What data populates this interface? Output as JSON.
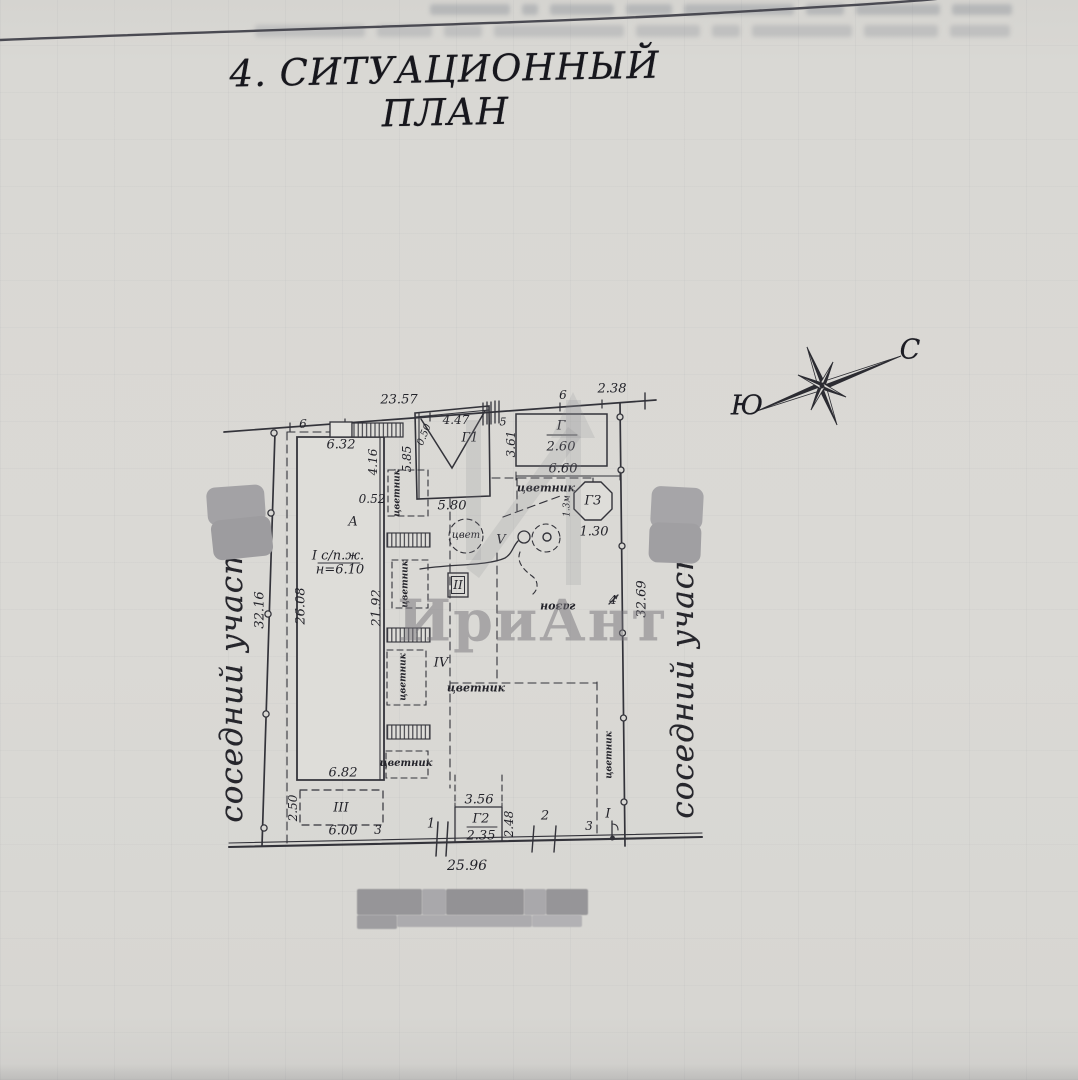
{
  "page": {
    "title": "4. СИТУАЦИОННЫЙ ПЛАН"
  },
  "compass": {
    "north_label": "С",
    "south_label": "Ю"
  },
  "site": {
    "neighbor_left": "соседний участок",
    "neighbor_right": "соседний участок",
    "watermark": "ИриАнт"
  },
  "colors": {
    "paper": "#d9d8d4",
    "ink": "#2b2b31",
    "watermark": "#8a8890"
  },
  "plan": {
    "labels": [
      {
        "n": "dim-23-57",
        "t": "23.57",
        "x": 399,
        "y": 400,
        "s": 13
      },
      {
        "n": "dim-6-a",
        "t": "6",
        "x": 303,
        "y": 424,
        "s": 12
      },
      {
        "n": "dim-6-32",
        "t": "6.32",
        "x": 341,
        "y": 445,
        "s": 13
      },
      {
        "n": "dim-4-16",
        "t": "4.16",
        "x": 373,
        "y": 462,
        "r": -90,
        "s": 12
      },
      {
        "n": "dim-5-85",
        "t": "5.85",
        "x": 407,
        "y": 459,
        "r": -90,
        "s": 12
      },
      {
        "n": "dim-0-50",
        "t": "0.50",
        "x": 425,
        "y": 435,
        "r": -68,
        "s": 10
      },
      {
        "n": "dim-4-47",
        "t": "4.47",
        "x": 456,
        "y": 420,
        "s": 12
      },
      {
        "n": "label-g1",
        "t": "Г1",
        "x": 470,
        "y": 438,
        "s": 13
      },
      {
        "n": "dim-5-b",
        "t": "5",
        "x": 503,
        "y": 422,
        "s": 11
      },
      {
        "n": "dim-3-61",
        "t": "3.61",
        "x": 511,
        "y": 444,
        "r": -90,
        "s": 12
      },
      {
        "n": "dim-6-b",
        "t": "6",
        "x": 563,
        "y": 395,
        "s": 12
      },
      {
        "n": "dim-2-38",
        "t": "2.38",
        "x": 612,
        "y": 389,
        "s": 13
      },
      {
        "n": "label-g",
        "t": "Г",
        "x": 561,
        "y": 426,
        "s": 13
      },
      {
        "n": "dim-2-60",
        "t": "2.60",
        "x": 561,
        "y": 447,
        "s": 13
      },
      {
        "n": "dim-6-60",
        "t": "6.60",
        "x": 563,
        "y": 469,
        "s": 13
      },
      {
        "n": "label-cvetnik-top",
        "t": "цветник",
        "x": 546,
        "y": 488,
        "s": 11,
        "b": 1
      },
      {
        "n": "label-g3",
        "t": "Г3",
        "x": 593,
        "y": 501,
        "s": 13
      },
      {
        "n": "dim-1-30",
        "t": "1.30",
        "x": 594,
        "y": 532,
        "s": 13
      },
      {
        "n": "dim-1-3m",
        "t": "1.3м",
        "x": 568,
        "y": 506,
        "r": -90,
        "s": 9
      },
      {
        "n": "label-cvet",
        "t": "цвет",
        "x": 466,
        "y": 536,
        "s": 10
      },
      {
        "n": "label-v",
        "t": "V",
        "x": 501,
        "y": 540,
        "s": 13
      },
      {
        "n": "dim-5-80",
        "t": "5.80",
        "x": 452,
        "y": 506,
        "s": 13
      },
      {
        "n": "dim-0-52",
        "t": "0.52",
        "x": 372,
        "y": 499,
        "s": 12
      },
      {
        "n": "label-a",
        "t": "А",
        "x": 353,
        "y": 522,
        "s": 13
      },
      {
        "n": "label-i-spzh",
        "t": "I с/п.ж.",
        "x": 338,
        "y": 556,
        "s": 13
      },
      {
        "n": "dim-n-6-10",
        "t": "н=6.10",
        "x": 340,
        "y": 570,
        "s": 13
      },
      {
        "n": "dim-26-08",
        "t": "26.08",
        "x": 301,
        "y": 606,
        "r": -90,
        "s": 13
      },
      {
        "n": "dim-32-16",
        "t": "32.16",
        "x": 260,
        "y": 610,
        "r": -90,
        "s": 13
      },
      {
        "n": "dim-21-92",
        "t": "21.92",
        "x": 377,
        "y": 608,
        "r": -90,
        "s": 13
      },
      {
        "n": "cvetnik-v0",
        "t": "цветник",
        "x": 398,
        "y": 493,
        "r": -90,
        "s": 9,
        "b": 1
      },
      {
        "n": "cvetnik-v1",
        "t": "цветник",
        "x": 406,
        "y": 584,
        "r": -90,
        "s": 9,
        "b": 1
      },
      {
        "n": "cvetnik-v2",
        "t": "цветник",
        "x": 404,
        "y": 677,
        "r": -90,
        "s": 9,
        "b": 1
      },
      {
        "n": "label-ii",
        "t": "II",
        "x": 458,
        "y": 585,
        "s": 12
      },
      {
        "n": "label-iv",
        "t": "IV",
        "x": 441,
        "y": 663,
        "s": 13
      },
      {
        "n": "label-cvetnik-mid",
        "t": "цветник",
        "x": 476,
        "y": 688,
        "s": 11,
        "b": 1
      },
      {
        "n": "label-gazon",
        "t": "газон",
        "x": 558,
        "y": 607,
        "r": 180,
        "s": 11,
        "b": 1
      },
      {
        "n": "dim-4",
        "t": "4",
        "x": 613,
        "y": 600,
        "s": 12
      },
      {
        "n": "dim-32-69",
        "t": "32.69",
        "x": 642,
        "y": 599,
        "r": -90,
        "s": 13
      },
      {
        "n": "cvetnik-h3",
        "t": "цветник",
        "x": 406,
        "y": 764,
        "s": 10,
        "b": 1
      },
      {
        "n": "cvetnik-v3",
        "t": "цветник",
        "x": 610,
        "y": 755,
        "r": -90,
        "s": 9,
        "b": 1
      },
      {
        "n": "dim-6-82",
        "t": "6.82",
        "x": 343,
        "y": 773,
        "s": 13
      },
      {
        "n": "dim-2-50",
        "t": "2.50",
        "x": 293,
        "y": 808,
        "r": -90,
        "s": 12
      },
      {
        "n": "label-iii",
        "t": "III",
        "x": 341,
        "y": 808,
        "s": 13
      },
      {
        "n": "dim-6-00",
        "t": "6.00",
        "x": 343,
        "y": 831,
        "s": 13
      },
      {
        "n": "dim-3-a",
        "t": "3",
        "x": 378,
        "y": 830,
        "s": 12
      },
      {
        "n": "gate-1",
        "t": "1",
        "x": 431,
        "y": 824,
        "s": 13
      },
      {
        "n": "dim-3-56",
        "t": "3.56",
        "x": 479,
        "y": 800,
        "s": 13
      },
      {
        "n": "label-g2",
        "t": "Г2",
        "x": 481,
        "y": 819,
        "s": 13
      },
      {
        "n": "dim-2-35",
        "t": "2.35",
        "x": 481,
        "y": 836,
        "s": 13
      },
      {
        "n": "dim-2-48",
        "t": "2.48",
        "x": 509,
        "y": 824,
        "r": -90,
        "s": 12
      },
      {
        "n": "gate-2",
        "t": "2",
        "x": 545,
        "y": 816,
        "s": 13
      },
      {
        "n": "gate-3",
        "t": "3",
        "x": 589,
        "y": 826,
        "s": 12
      },
      {
        "n": "label-i-gate",
        "t": "I",
        "x": 608,
        "y": 814,
        "s": 13
      },
      {
        "n": "dim-25-96",
        "t": "25.96",
        "x": 467,
        "y": 866,
        "s": 14
      }
    ]
  }
}
